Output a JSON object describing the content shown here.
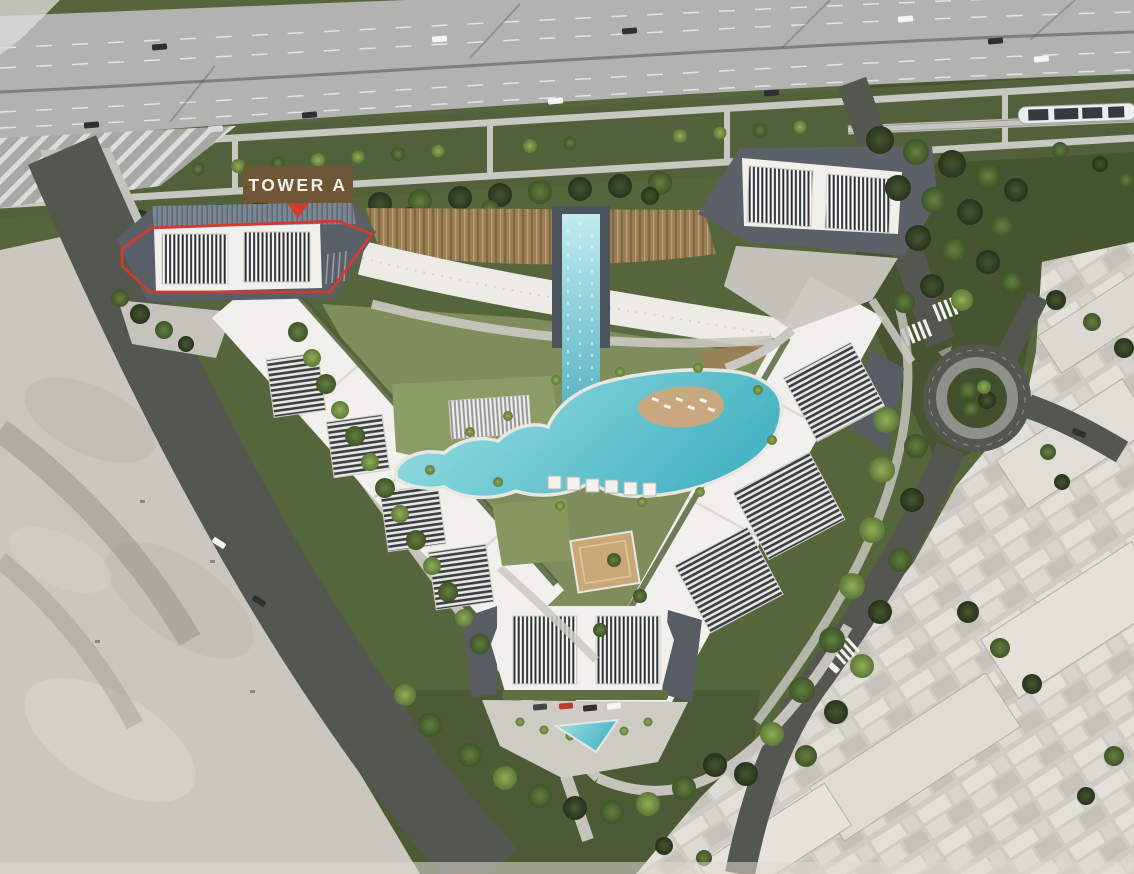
{
  "annotation": {
    "label": "TOWER A"
  },
  "colors": {
    "highlight_red": "#d23a2e",
    "label_background": "#6f5636",
    "label_text": "#f6f0e4",
    "pool_turquoise": "#49b4c4",
    "grass_green": "#55663c",
    "sand_beige": "#cbc7bf",
    "highway_gray": "#b2b3b0",
    "road_gray": "#54574f",
    "building_white": "#f1f0ec",
    "bronze_roof": "#9b7f53"
  }
}
